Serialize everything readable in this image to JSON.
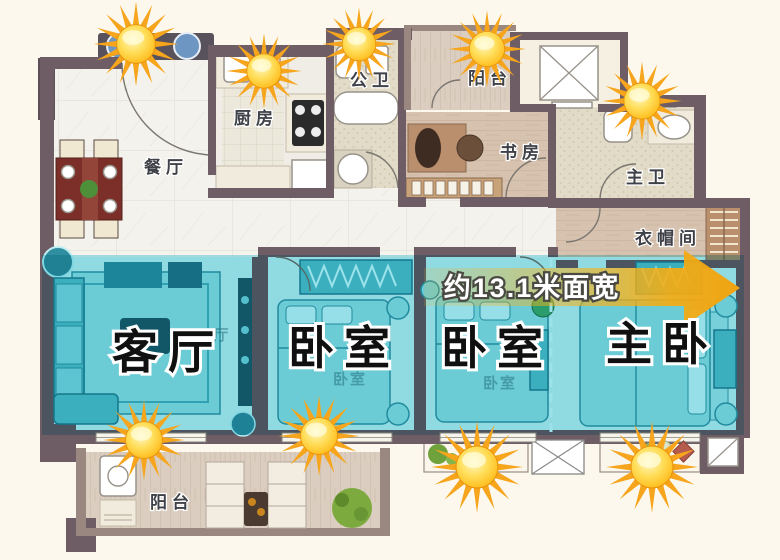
{
  "page": {
    "type": "apartment-floor-plan",
    "background": "#FBF6EA"
  },
  "rooms": {
    "dining": "餐厅",
    "kitchen": "厨房",
    "guest_bath": "公卫",
    "balcony_top": "阳台",
    "study": "书房",
    "master_bath": "主卫",
    "cloakroom": "衣帽间",
    "balcony_bottom": "阳台"
  },
  "highlighted_rooms": {
    "living": "客厅",
    "bedroom_a": "卧室",
    "bedroom_b": "卧室",
    "master": "主卧"
  },
  "underlying_labels": {
    "hall": "厅",
    "bedroom": "卧室"
  },
  "annotation": {
    "width_label": "约13.1米面宽"
  },
  "icons": {
    "sun_count": 9
  },
  "colors": {
    "wall": "#6F5D66",
    "highlight_overlay": "#2CC1D3",
    "arrow": "#F5B017",
    "sun": "#FFC31F",
    "background": "#FBF6EA"
  }
}
